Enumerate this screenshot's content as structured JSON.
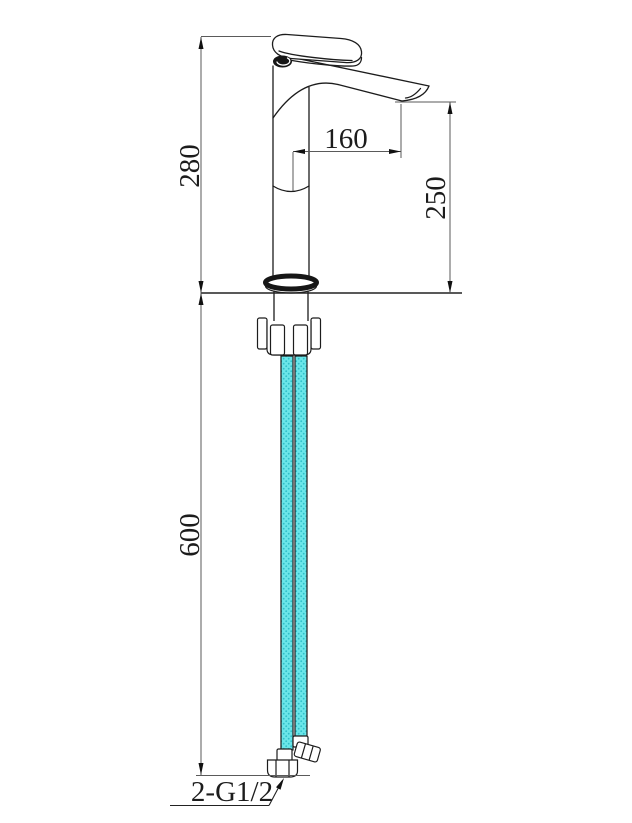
{
  "drawing_title": "basin-faucet-dimension-drawing",
  "dimensions": {
    "overall_height": "280",
    "spout_reach": "160",
    "spout_height": "250",
    "hose_length": "600",
    "connection_thread": "2-G1/2"
  },
  "colors": {
    "hose_fill": "#6ae6e9",
    "hose_dot": "#2fc0ca",
    "object_line": "#1c1c1c",
    "dimension_line": "#5a5a5a",
    "background": "#ffffff"
  }
}
